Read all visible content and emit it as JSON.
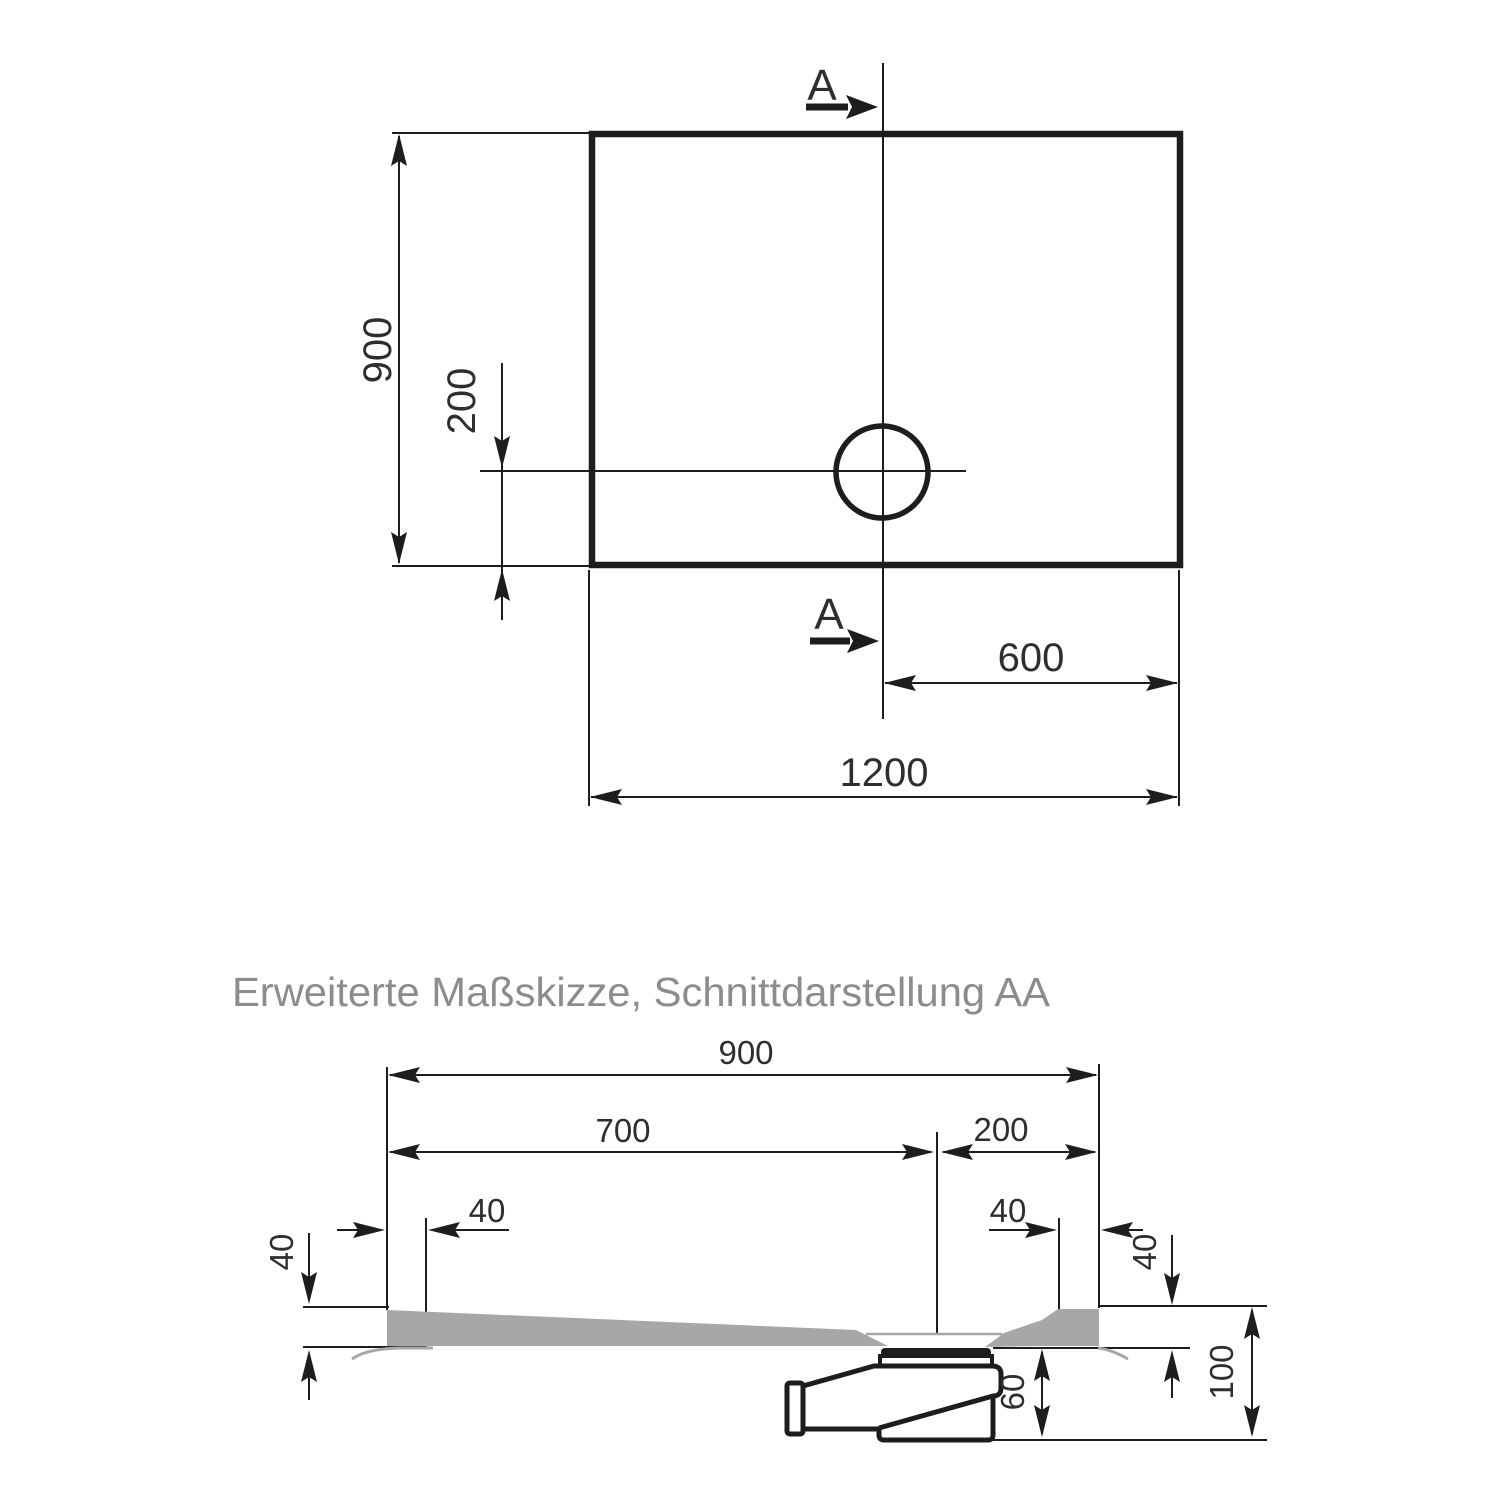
{
  "title": "Erweiterte Maßskizze, Schnittdarstellung AA",
  "top_view": {
    "width_label": "1200",
    "height_label": "900",
    "drain_offset_bottom_label": "200",
    "drain_offset_right_label": "600",
    "section_marker": "A"
  },
  "section_view": {
    "overall_width_label": "900",
    "drain_from_left_label": "700",
    "drain_from_right_label": "200",
    "rim_flat_left_label": "40",
    "rim_flat_right_label": "40",
    "edge_height_left_label": "40",
    "edge_height_right_label": "40",
    "drain_trap_height_label": "60",
    "total_height_label": "100"
  },
  "colors": {
    "line": "#1d1d1b",
    "dimension_text": "#2e2e2e",
    "tray_fill": "#a7a7a7",
    "title_text": "#8c8c8c"
  }
}
